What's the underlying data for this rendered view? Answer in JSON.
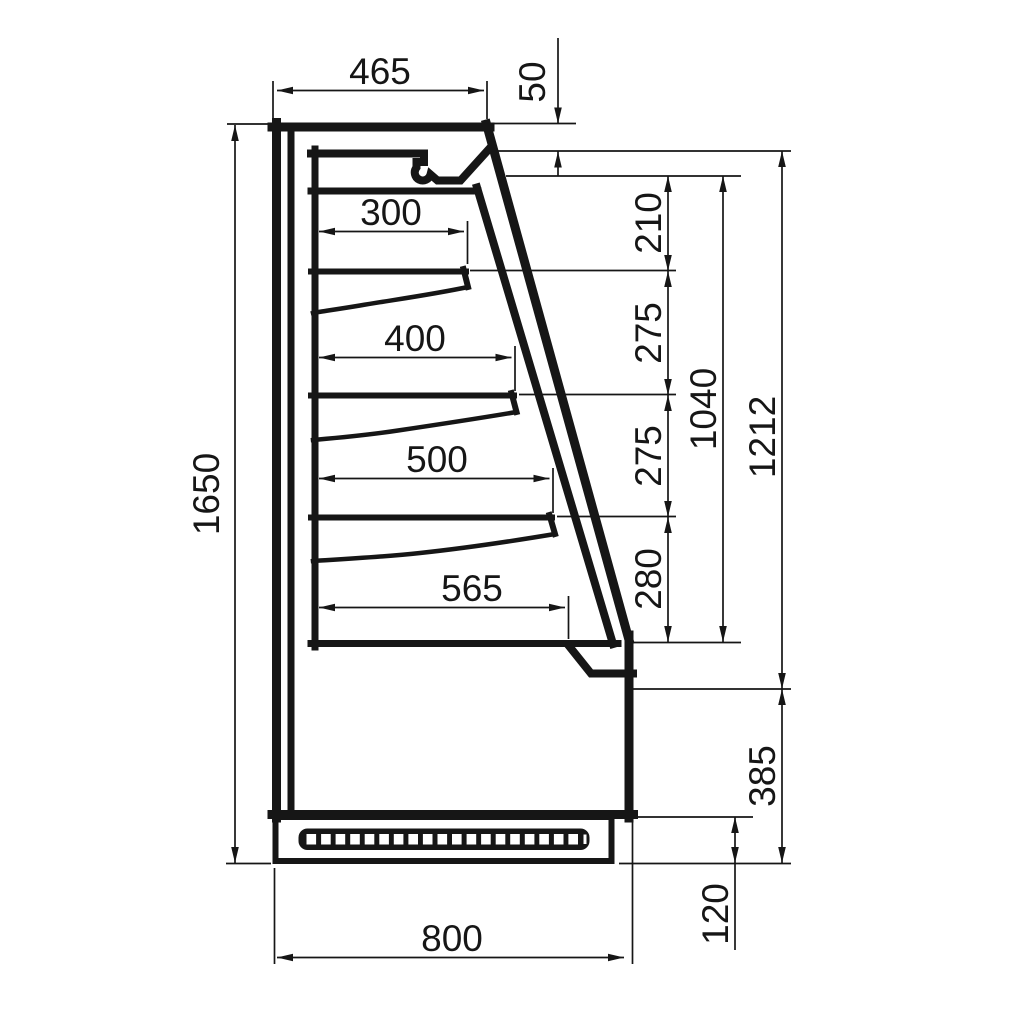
{
  "drawing": {
    "subject": "refrigerated wall display cabinet side cross-section",
    "colors": {
      "line": "#161616",
      "background": "#ffffff"
    },
    "dims": {
      "top_depth": "465",
      "canopy_lip": "50",
      "overall_height": "1650",
      "overall_depth": "800",
      "shelf1_depth": "300",
      "shelf2_depth": "400",
      "shelf3_depth": "500",
      "deck_depth": "565",
      "canopy_to_shelf1": "210",
      "shelf1_to_shelf2": "275",
      "shelf2_to_shelf3": "275",
      "shelf3_to_deck": "280",
      "opening_height": "1040",
      "front_height": "1212",
      "lower_front_height": "385",
      "plinth_height": "120"
    }
  }
}
